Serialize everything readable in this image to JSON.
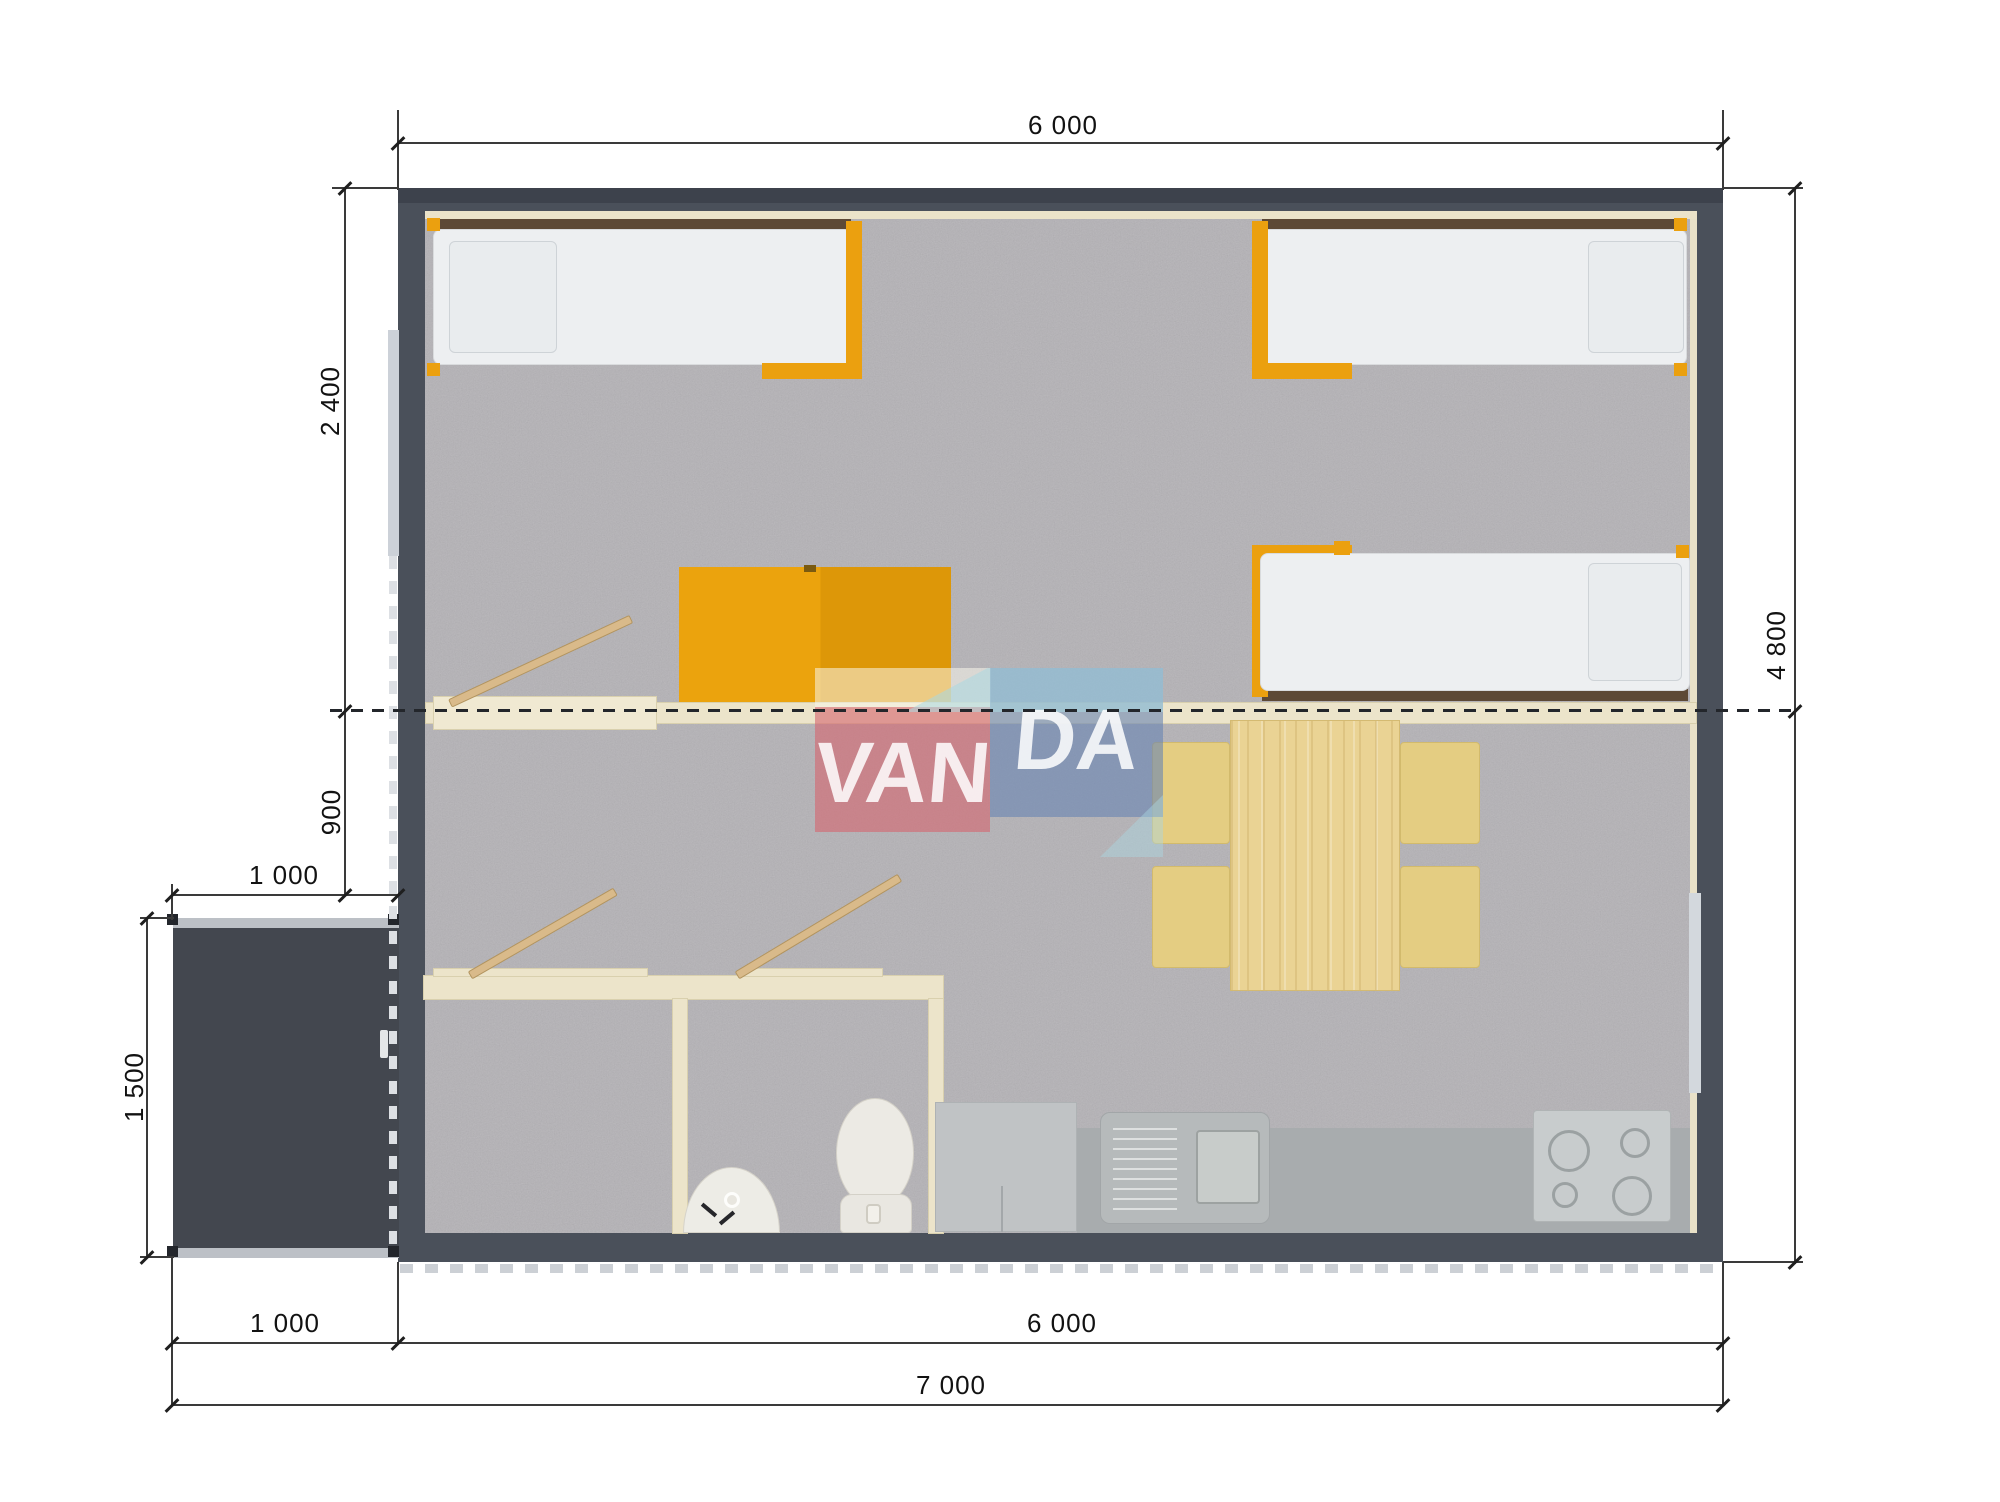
{
  "watermark": {
    "left": "VAN",
    "right": "DA"
  },
  "dimensions": {
    "top_width": "6 000",
    "bedroom_depth": "2 400",
    "hall_depth": "900",
    "porch_width_top": "1 000",
    "porch_depth": "1 500",
    "total_depth": "4 800",
    "porch_width_bottom": "1 000",
    "body_width_bottom": "6 000",
    "total_width": "7 000"
  },
  "colors": {
    "wall": "#4a505a",
    "porch": "#43474f",
    "carpet": "#b4b2b6",
    "cream_partition": "#ece4ca",
    "accent_orange": "#eba00f",
    "headboard_brown": "#5d4936",
    "wood_table": "#ead394",
    "chair_yellow": "#e4cd82",
    "counter_gray": "#a8acae",
    "logo_pink": "#d5646e",
    "logo_blue": "#6884b2",
    "logo_light_blue": "#aad8e2"
  }
}
